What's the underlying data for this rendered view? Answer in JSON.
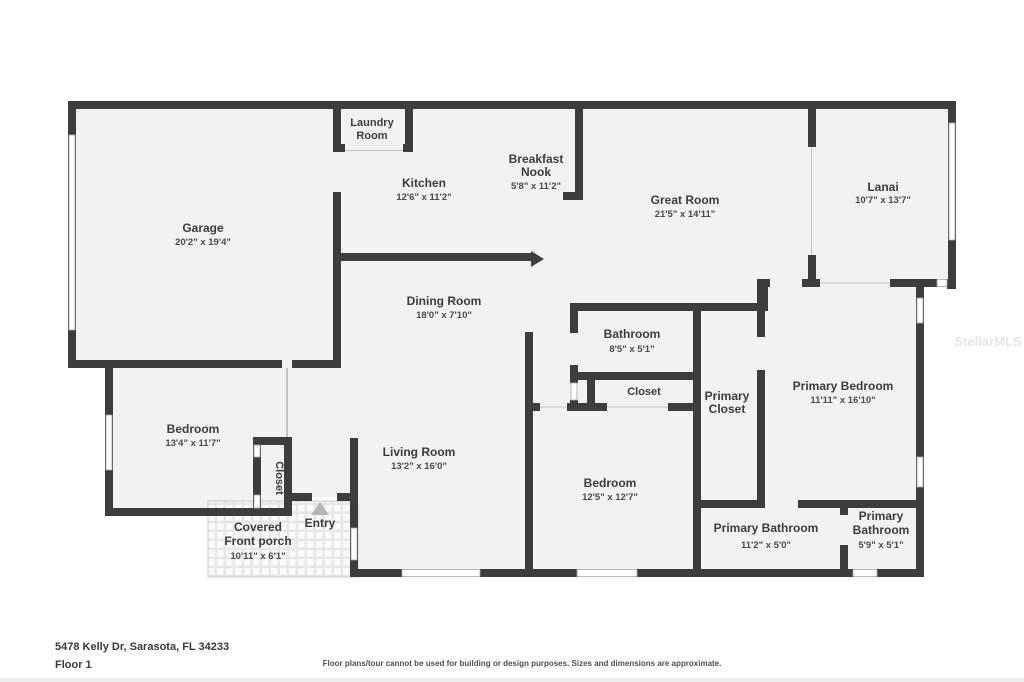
{
  "floorplan": {
    "rooms": {
      "garage": {
        "name": "Garage",
        "dims": "20'2\" x 19'4\""
      },
      "laundry": {
        "line1": "Laundry",
        "line2": "Room"
      },
      "kitchen": {
        "name": "Kitchen",
        "dims": "12'6\" x 11'2\""
      },
      "breakfast_nook": {
        "line1": "Breakfast",
        "line2": "Nook",
        "dims": "5'8\" x 11'2\""
      },
      "great_room": {
        "name": "Great Room",
        "dims": "21'5\" x 14'11\""
      },
      "lanai": {
        "name": "Lanai",
        "dims": "10'7\" x 13'7\""
      },
      "dining_room": {
        "name": "Dining Room",
        "dims": "18'0\" x 7'10\""
      },
      "bathroom": {
        "name": "Bathroom",
        "dims": "8'5\" x 5'1\""
      },
      "hall_closet": {
        "name": "Closet"
      },
      "primary_closet": {
        "line1": "Primary",
        "line2": "Closet"
      },
      "primary_bedroom": {
        "name": "Primary Bedroom",
        "dims": "11'11\" x 16'10\""
      },
      "bedroom_left": {
        "name": "Bedroom",
        "dims": "13'4\" x 11'7\""
      },
      "bedroom_closet": {
        "name": "Closet"
      },
      "living_room": {
        "name": "Living Room",
        "dims": "13'2\" x 16'0\""
      },
      "bedroom_center": {
        "name": "Bedroom",
        "dims": "12'5\" x 12'7\""
      },
      "primary_bathroom_1": {
        "name": "Primary Bathroom",
        "dims": "11'2\" x 5'0\""
      },
      "primary_bathroom_2": {
        "line1": "Primary",
        "line2": "Bathroom",
        "dims": "5'9\" x 5'1\""
      },
      "porch": {
        "line1": "Covered",
        "line2": "Front porch",
        "dims": "10'11\" x 6'1\""
      },
      "entry": {
        "name": "Entry"
      }
    },
    "colors": {
      "wall": "#3d3d3d",
      "floor": "#f2f2f2",
      "label_text": "#3c3c3c"
    }
  },
  "watermark": "StellarMLS",
  "footer": {
    "address": "5478 Kelly Dr, Sarasota, FL 34233",
    "floor_label": "Floor 1",
    "disclaimer": "Floor plans/tour cannot be used for building or design purposes. Sizes and dimensions are approximate."
  }
}
